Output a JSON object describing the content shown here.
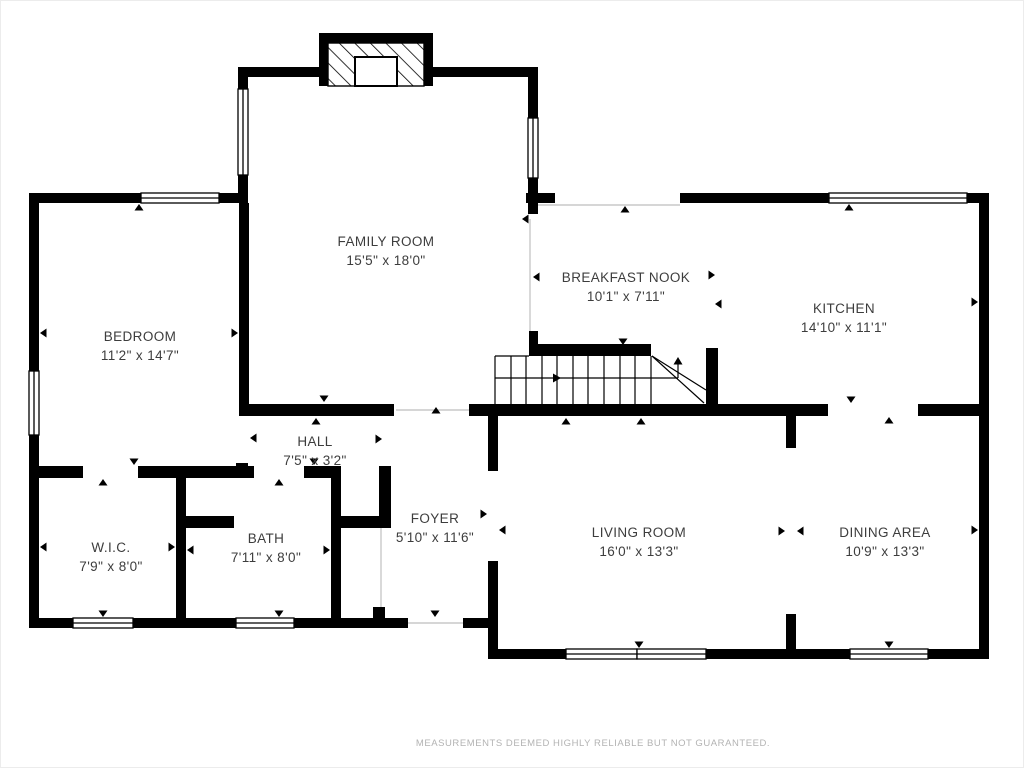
{
  "page": {
    "type": "floor-plan",
    "footer": "MEASUREMENTS DEEMED HIGHLY RELIABLE BUT NOT GUARANTEED."
  },
  "colors": {
    "wall": "#000000",
    "label_text": "#3d3d3d",
    "footer_text": "#b3b3b3",
    "open_boundary_line": "#c9c9c9",
    "background": "#ffffff"
  },
  "rooms": [
    {
      "id": "family-room",
      "name": "FAMILY ROOM",
      "dims": "15'5\" x 18'0\""
    },
    {
      "id": "breakfast-nook",
      "name": "BREAKFAST NOOK",
      "dims": "10'1\" x 7'11\""
    },
    {
      "id": "kitchen",
      "name": "KITCHEN",
      "dims": "14'10\" x 11'1\""
    },
    {
      "id": "bedroom",
      "name": "BEDROOM",
      "dims": "11'2\" x 14'7\""
    },
    {
      "id": "hall",
      "name": "HALL",
      "dims": "7'5\" x 3'2\""
    },
    {
      "id": "wic",
      "name": "W.I.C.",
      "dims": "7'9\" x 8'0\""
    },
    {
      "id": "bath",
      "name": "BATH",
      "dims": "7'11\" x 8'0\""
    },
    {
      "id": "foyer",
      "name": "FOYER",
      "dims": "5'10\" x 11'6\""
    },
    {
      "id": "living-room",
      "name": "LIVING ROOM",
      "dims": "16'0\" x 13'3\""
    },
    {
      "id": "dining-area",
      "name": "DINING AREA",
      "dims": "10'9\" x 13'3\""
    }
  ],
  "features": {
    "fireplace": "chimney-with-firebox-at-top-of-family-room",
    "staircase": "u-winder-stairs-up-between-breakfast-nook-and-living-room"
  }
}
